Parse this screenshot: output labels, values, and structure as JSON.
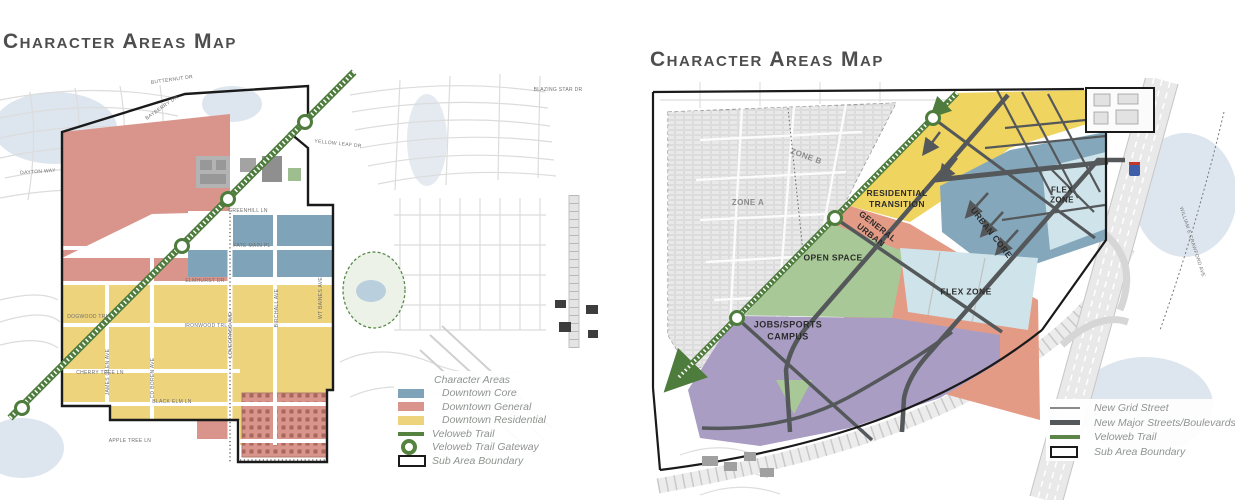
{
  "palette": {
    "downtown_core": "#7FA3B8",
    "downtown_general": "#D9958B",
    "downtown_residential": "#EDD37B",
    "veloweb_green": "#55833F",
    "boundary_black": "#1A1A1A",
    "residential_transition_yellow": "#EFD45F",
    "general_urban_salmon": "#E49B85",
    "urban_core_blue": "#84A7BB",
    "flex_zone_blue": "#CFE4EA",
    "open_space_green": "#A8C897",
    "jobs_campus_purple": "#A99DC3",
    "major_street_gray": "#55585A",
    "grid_street_gray": "#8A8A8A"
  },
  "left_map": {
    "title": "Character Areas Map",
    "legend": {
      "header": "Character Areas",
      "items": [
        {
          "label": "Downtown Core",
          "color": "#7FA3B8"
        },
        {
          "label": "Downtown General",
          "color": "#D9958B"
        },
        {
          "label": "Downtown Residential",
          "color": "#EDD37B"
        },
        {
          "label": "Veloweb Trail",
          "color": "#55833F"
        },
        {
          "label": "Veloweb Trail Gateway",
          "color": "#55833F"
        },
        {
          "label": "Sub Area Boundary",
          "color": "#1A1A1A"
        }
      ]
    },
    "street_labels": [
      {
        "text": "BUTTERNUT DR",
        "x": 172,
        "y": 80,
        "r": -8
      },
      {
        "text": "BAYBERRY DR",
        "x": 162,
        "y": 108,
        "r": -35
      },
      {
        "text": "BLAZING STAR DR",
        "x": 558,
        "y": 90,
        "r": 0
      },
      {
        "text": "YELLOW LEAF DR",
        "x": 338,
        "y": 144,
        "r": 6
      },
      {
        "text": "DAYTON WAY",
        "x": 38,
        "y": 172,
        "r": -4
      },
      {
        "text": "GREENHILL LN",
        "x": 248,
        "y": 211,
        "r": 0
      },
      {
        "text": "FATE MAIN PL",
        "x": 252,
        "y": 246,
        "r": 0
      },
      {
        "text": "ELMHURST DR",
        "x": 205,
        "y": 281,
        "r": 0
      },
      {
        "text": "DOGWOOD TRL",
        "x": 88,
        "y": 317,
        "r": 0
      },
      {
        "text": "IRONWOOD TRL",
        "x": 206,
        "y": 326,
        "r": 0
      },
      {
        "text": "CHERRY TREE LN",
        "x": 100,
        "y": 373,
        "r": 0
      },
      {
        "text": "BLACK ELM LN",
        "x": 172,
        "y": 402,
        "r": 0
      },
      {
        "text": "APPLE TREE LN",
        "x": 130,
        "y": 441,
        "r": 0
      },
      {
        "text": "JAMES GLEN AVE",
        "x": 108,
        "y": 372,
        "r": -90
      },
      {
        "text": "CD BOREN AVE",
        "x": 153,
        "y": 378,
        "r": -90
      },
      {
        "text": "LOVEGRASS AVE",
        "x": 231,
        "y": 335,
        "r": -90
      },
      {
        "text": "BIRCHALL AVE",
        "x": 277,
        "y": 308,
        "r": -90
      },
      {
        "text": "WT BAINES AVE",
        "x": 321,
        "y": 298,
        "r": -90
      }
    ]
  },
  "right_map": {
    "title": "Character Areas Map",
    "zone_labels": [
      {
        "lines": [
          "RESIDENTIAL",
          "TRANSITION"
        ],
        "x": 897,
        "y": 199,
        "r": 0,
        "s": 8.5
      },
      {
        "lines": [
          "GENERAL",
          "URBAN"
        ],
        "x": 874,
        "y": 231,
        "r": 38,
        "s": 8.5
      },
      {
        "lines": [
          "URBAN CORE"
        ],
        "x": 991,
        "y": 233,
        "r": 52,
        "s": 8.5
      },
      {
        "lines": [
          "FLEX",
          "ZONE"
        ],
        "x": 1062,
        "y": 196,
        "r": 0,
        "s": 8
      },
      {
        "lines": [
          "FLEX ZONE"
        ],
        "x": 966,
        "y": 292,
        "r": 0,
        "s": 8.5
      },
      {
        "lines": [
          "OPEN SPACE"
        ],
        "x": 833,
        "y": 258,
        "r": 0,
        "s": 8.5
      },
      {
        "lines": [
          "JOBS/SPORTS",
          "CAMPUS"
        ],
        "x": 788,
        "y": 331,
        "r": 0,
        "s": 9
      },
      {
        "lines": [
          "ZONE A"
        ],
        "x": 748,
        "y": 203,
        "r": 0,
        "s": 8,
        "c": "#8a8a8a"
      },
      {
        "lines": [
          "ZONE B"
        ],
        "x": 806,
        "y": 157,
        "r": 20,
        "s": 8,
        "c": "#8a8a8a"
      }
    ],
    "street_labels": [
      {
        "text": "WILLIAM E CRAWFORD AVE",
        "x": 1192,
        "y": 242,
        "r": 72
      }
    ],
    "legend": {
      "items": [
        {
          "label": "New Grid Street",
          "color": "#8A8A8A"
        },
        {
          "label": "New Major Streets/Boulevards",
          "color": "#55585A"
        },
        {
          "label": "Veloweb Trail",
          "color": "#5D8549"
        },
        {
          "label": "Sub Area Boundary",
          "color": "#1A1A1A"
        }
      ]
    }
  }
}
